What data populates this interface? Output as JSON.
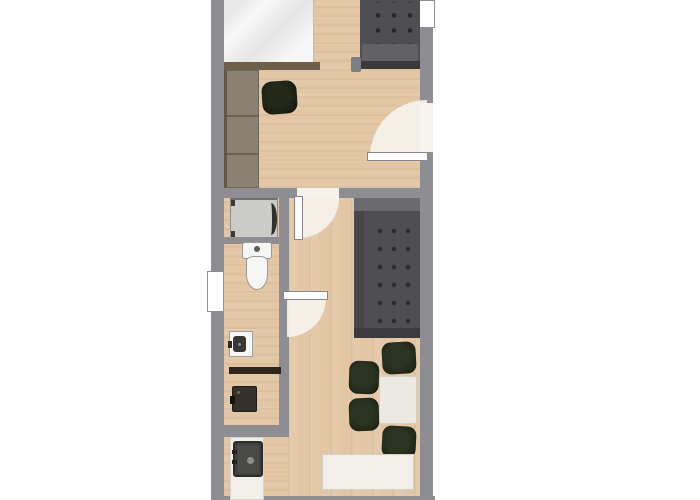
{
  "palette": {
    "background": "#ffffff",
    "wall": "#8d8d92",
    "floor": "#e3c7a5",
    "window": "#ffffff",
    "door_leaf": "#ffffff",
    "door_swing": "#f6f3ed",
    "bed": "#f1f1f1",
    "bed_frame": "#6e5f49",
    "wardrobe": "#8b8173",
    "sofa": "#4f4f53",
    "sofa_seat": "#626266",
    "dining_chair": "#2b3420",
    "table": "#ebe9e1",
    "counter": "#f0efe9",
    "appliance": "#cbcbc9",
    "fixture_white": "#f6f6f4",
    "fixture_line": "#9a9a98",
    "sink_dark": "#3f3f3d",
    "shower_dark": "#2c261e"
  },
  "rooms": [
    {
      "id": "bedroom",
      "position": "top"
    },
    {
      "id": "living-room",
      "position": "right"
    },
    {
      "id": "bathroom",
      "position": "middle-left"
    },
    {
      "id": "kitchen",
      "position": "bottom-left"
    }
  ],
  "objects": [
    "bed",
    "bed-footboard",
    "wardrobe",
    "desk-chair",
    "loveseat-sofa",
    "side-table",
    "entry-door",
    "bedroom-door",
    "bathroom-door",
    "washing-machine",
    "toilet",
    "bathroom-sink",
    "shower-partition",
    "shower-unit",
    "sofa",
    "dining-table",
    "dining-chair-top",
    "dining-chair-left-1",
    "dining-chair-left-2",
    "dining-chair-bottom",
    "kitchen-island",
    "kitchen-counter",
    "kitchen-sink",
    "left-window",
    "top-right-window"
  ]
}
